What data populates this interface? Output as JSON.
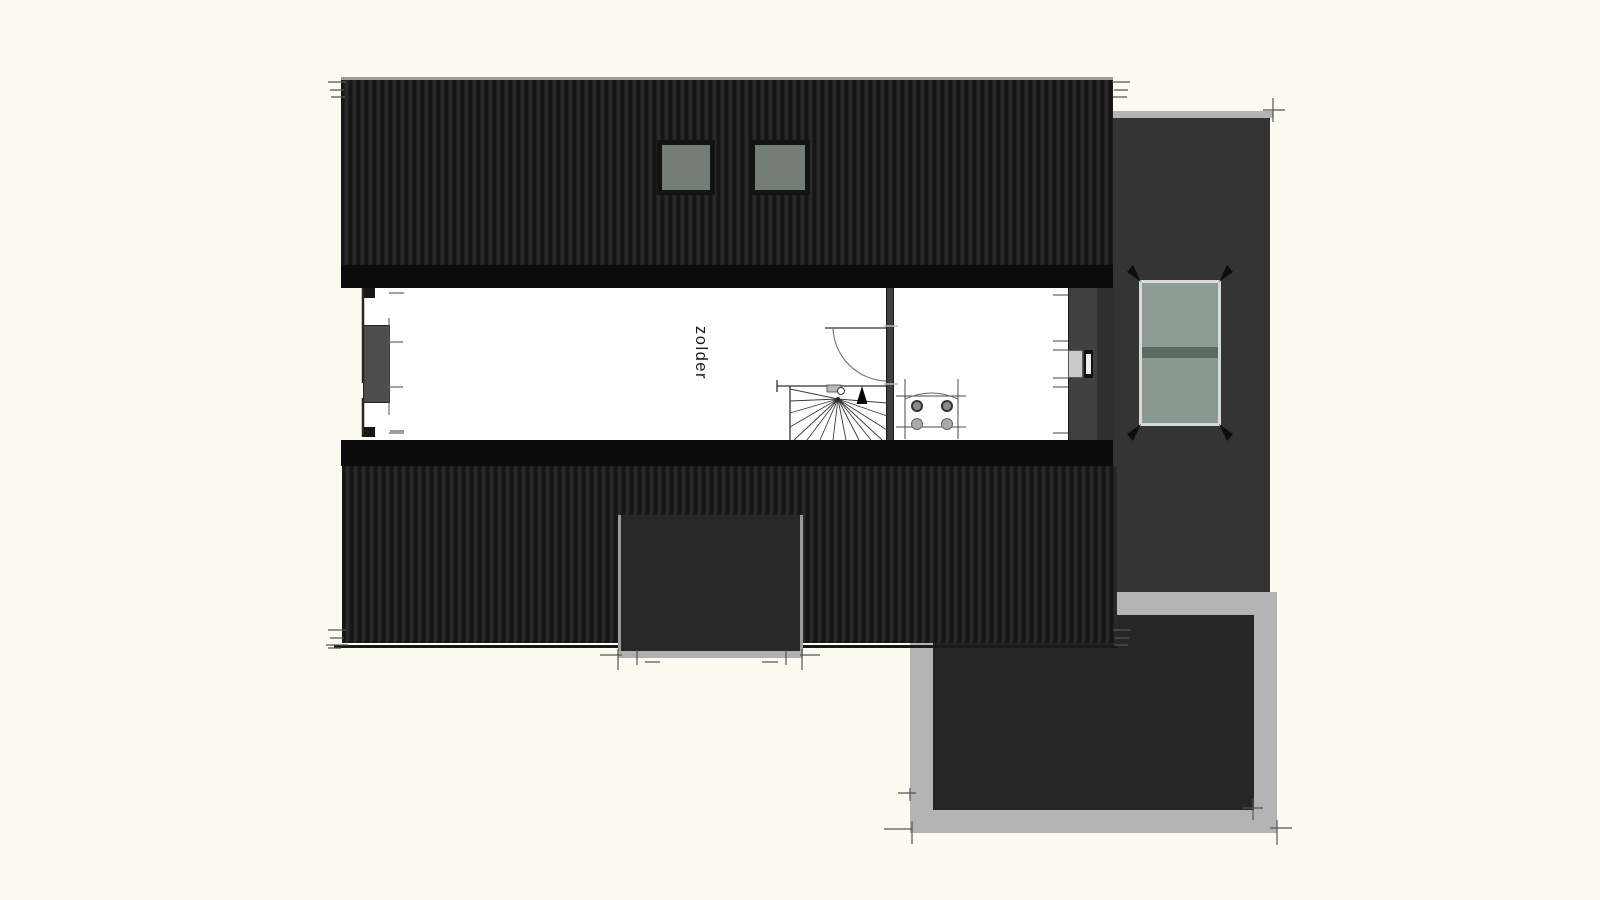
{
  "rooms": [
    {
      "name": "zolder"
    }
  ],
  "colors": {
    "bg": "#FDFAF2",
    "hatch-dark": "#161616",
    "hatch-light": "#2b2b2b",
    "ridge-band": "#0b0b0b",
    "floor": "#FFFFFF",
    "wall": "#3f3f3f",
    "right-wing": "#343434",
    "flat-border": "#b4b4b4",
    "flat-inner": "#262626",
    "dormer": "#272727",
    "dormer-edge": "#9a9a9a",
    "glass": "#757d77",
    "glass-frame": "#131313",
    "win-glass-top": "#8e9e97",
    "win-glass-bottom": "#8a998f",
    "win-divider": "#5a6b62",
    "win-frame": "#d8d8d8",
    "tick": "#6a6a6a",
    "line": "#333333",
    "text": "#1b1b1b"
  },
  "icons": {
    "stair_arrow": "up-direction-arrow",
    "door_swing": "quarter-arc-door-swing"
  }
}
